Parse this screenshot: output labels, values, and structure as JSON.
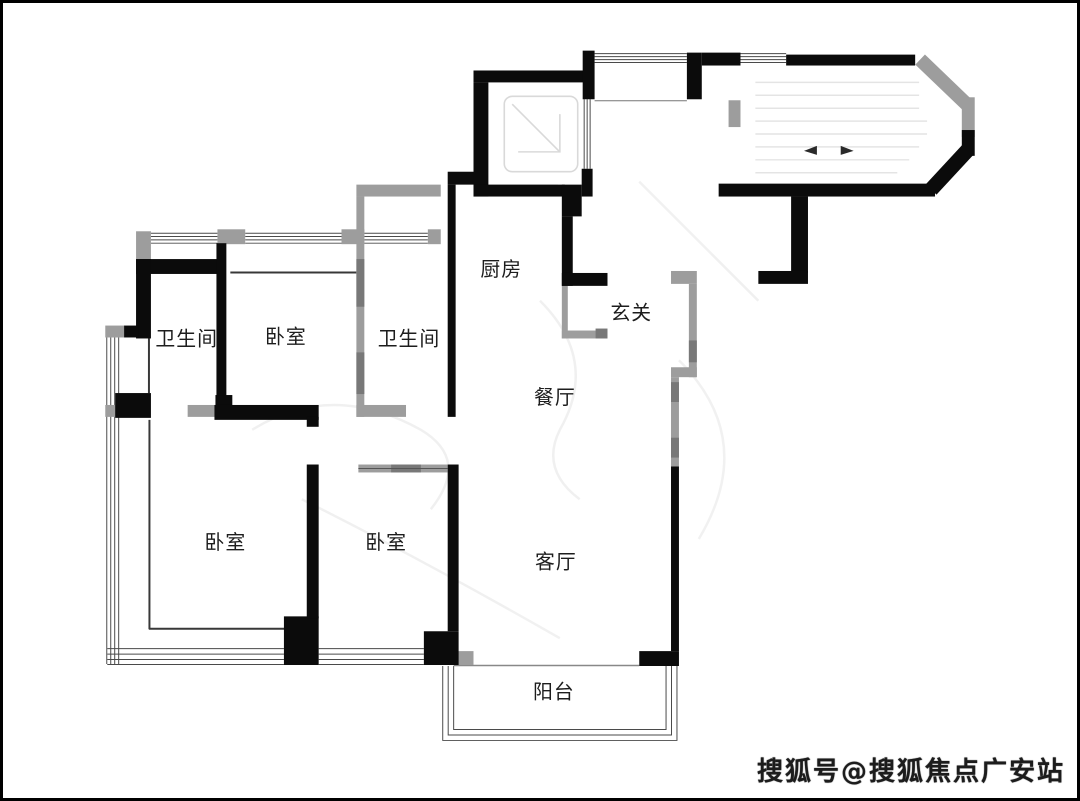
{
  "plan": {
    "title_hint": "residential floor plan",
    "rooms": {
      "kitchen": {
        "label": "厨房"
      },
      "entry": {
        "label": "玄关"
      },
      "bathroom_top": {
        "label": "卫生间"
      },
      "bedroom_top": {
        "label": "卧室"
      },
      "bathroom_mid": {
        "label": "卫生间"
      },
      "dining": {
        "label": "餐厅"
      },
      "bedroom_left": {
        "label": "卧室"
      },
      "bedroom_mid": {
        "label": "卧室"
      },
      "living": {
        "label": "客厅"
      },
      "balcony": {
        "label": "阳台"
      }
    },
    "colors": {
      "wall_black": "#0b0b0b",
      "wall_gray": "#9d9d9d",
      "wall_gray_dark": "#787878",
      "window_line": "#4a4a4a",
      "thin_wall": "#383838",
      "label_text": "#1d1d1d",
      "background": "#ffffff",
      "border": "#000000"
    }
  },
  "watermark": {
    "text": "搜狐号@搜狐焦点广安站"
  }
}
